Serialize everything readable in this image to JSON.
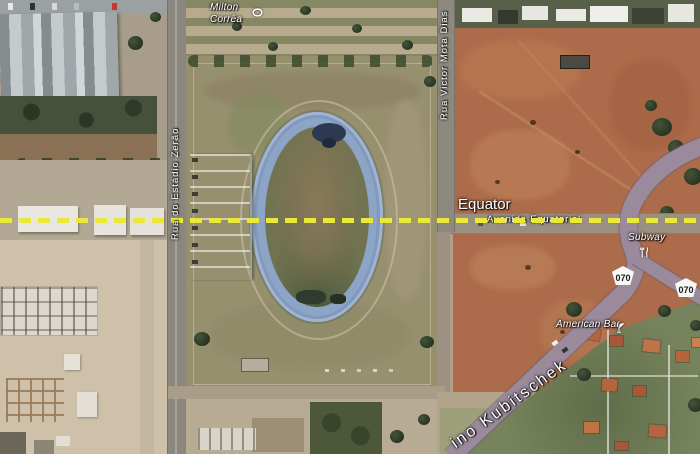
{
  "map": {
    "equator": {
      "label": "Equator"
    },
    "roads": {
      "avenida_equatorial": "Avenida Equatorial",
      "rua_do_estadio_zerao": "Rua do Estádio Zerão",
      "rua_victor_mota_dias": "Rua Victor Mota Dias",
      "avenida_kubitschek_visible": "ino Kubitschek"
    },
    "pois": {
      "stadium_line1": "Milton",
      "stadium_line2": "Corrêa",
      "restaurant": "Subway",
      "bar": "American Bar"
    },
    "highway_shields": [
      {
        "number": "070"
      },
      {
        "number": "070"
      }
    ],
    "colors": {
      "equator_line": "#ebe83c",
      "track_blue": "#8ca4c6",
      "red_dirt": "#ac6b4a",
      "highway_purple": "#9b8a9c",
      "label_text": "#ffffff"
    }
  }
}
